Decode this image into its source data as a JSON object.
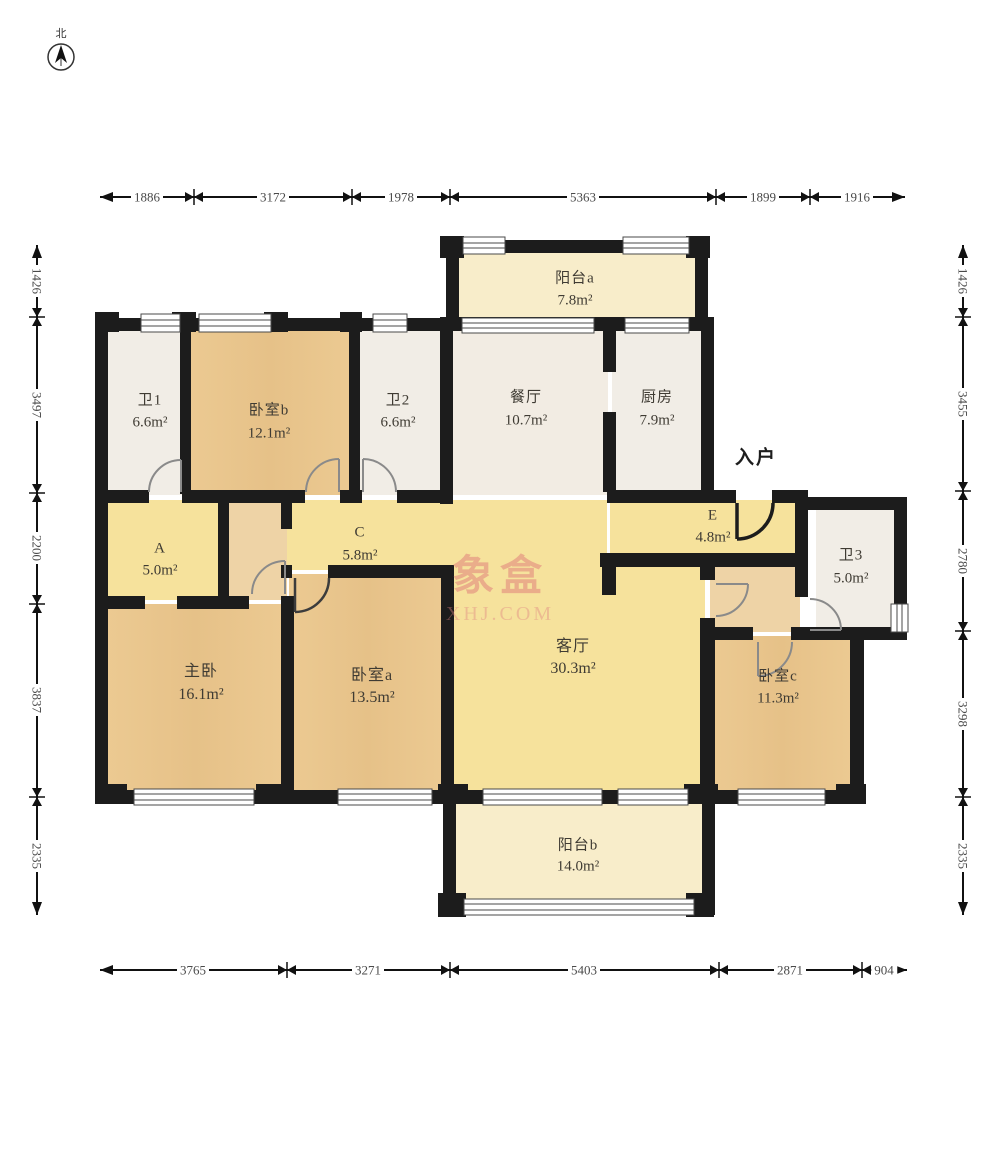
{
  "compass": {
    "north_label": "北"
  },
  "entry": {
    "label": "入户"
  },
  "watermark": {
    "title": "象盒",
    "site": "XHJ.COM"
  },
  "rooms": {
    "bath1": {
      "name": "卫1",
      "area": "6.6m²"
    },
    "bedroom_b": {
      "name": "卧室b",
      "area": "12.1m²"
    },
    "bath2": {
      "name": "卫2",
      "area": "6.6m²"
    },
    "balcony_a": {
      "name": "阳台a",
      "area": "7.8m²"
    },
    "dining": {
      "name": "餐厅",
      "area": "10.7m²"
    },
    "kitchen": {
      "name": "厨房",
      "area": "7.9m²"
    },
    "room_a": {
      "name": "A",
      "area": "5.0m²"
    },
    "room_c": {
      "name": "C",
      "area": "5.8m²"
    },
    "room_e": {
      "name": "E",
      "area": "4.8m²"
    },
    "bath3": {
      "name": "卫3",
      "area": "5.0m²"
    },
    "master": {
      "name": "主卧",
      "area": "16.1m²"
    },
    "bedroom_a": {
      "name": "卧室a",
      "area": "13.5m²"
    },
    "living": {
      "name": "客厅",
      "area": "30.3m²"
    },
    "bedroom_c": {
      "name": "卧室c",
      "area": "11.3m²"
    },
    "balcony_b": {
      "name": "阳台b",
      "area": "14.0m²"
    }
  },
  "dimensions": {
    "top": [
      "1886",
      "3172",
      "1978",
      "5363",
      "1899",
      "1916"
    ],
    "bottom": [
      "3765",
      "3271",
      "5403",
      "2871",
      "904"
    ],
    "left": [
      "1426",
      "3497",
      "2200",
      "3837",
      "2335"
    ],
    "right": [
      "1426",
      "3455",
      "2780",
      "3298",
      "2335"
    ]
  },
  "colors": {
    "wall": "#1c1c1c",
    "wood_floor": "#eac88f",
    "hall_yellow": "#f6e29c",
    "balcony_cream": "#f8edca",
    "tile_white": "#f1ede6",
    "watermark_pink": "#de7878"
  }
}
